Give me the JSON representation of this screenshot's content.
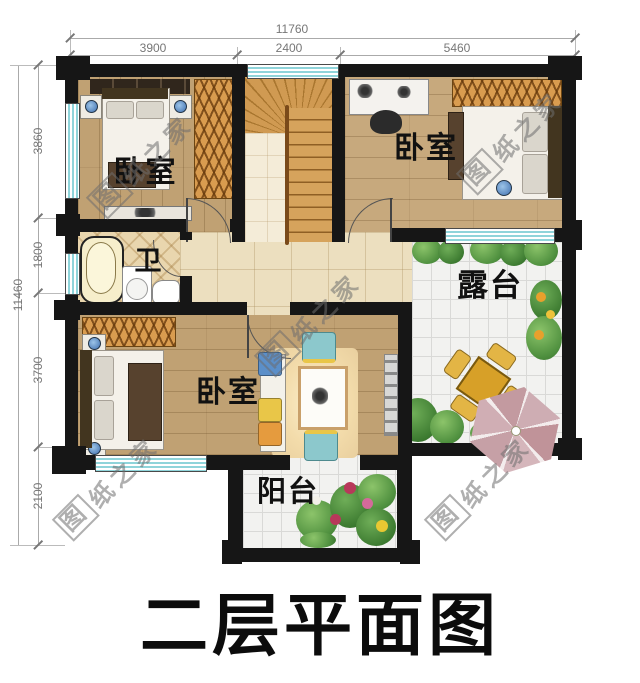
{
  "title": "二层平面图",
  "watermark": {
    "first": "图",
    "rest": "纸之家"
  },
  "dimensions": {
    "top": {
      "overall": "11760",
      "segments": [
        "3900",
        "2400",
        "5460"
      ]
    },
    "left": {
      "overall": "11460",
      "segments": [
        "3860",
        "1800",
        "3700",
        "2100"
      ]
    }
  },
  "rooms": {
    "bedroom_top_left": {
      "label": "卧室"
    },
    "bedroom_top_right": {
      "label": "卧室"
    },
    "bedroom_bottom": {
      "label": "卧室"
    },
    "bathroom": {
      "label": "卫"
    },
    "terrace": {
      "label": "露台"
    },
    "balcony": {
      "label": "阳台"
    }
  },
  "colors": {
    "wall": "#161616",
    "window-glass": "#8fd4da",
    "wood": "#c0a173",
    "stair": "#c98f46",
    "hall": "#ecdfbf",
    "terr": "#f2f2f0",
    "accent-orange": "#d99c4f",
    "ink": "#111111"
  }
}
